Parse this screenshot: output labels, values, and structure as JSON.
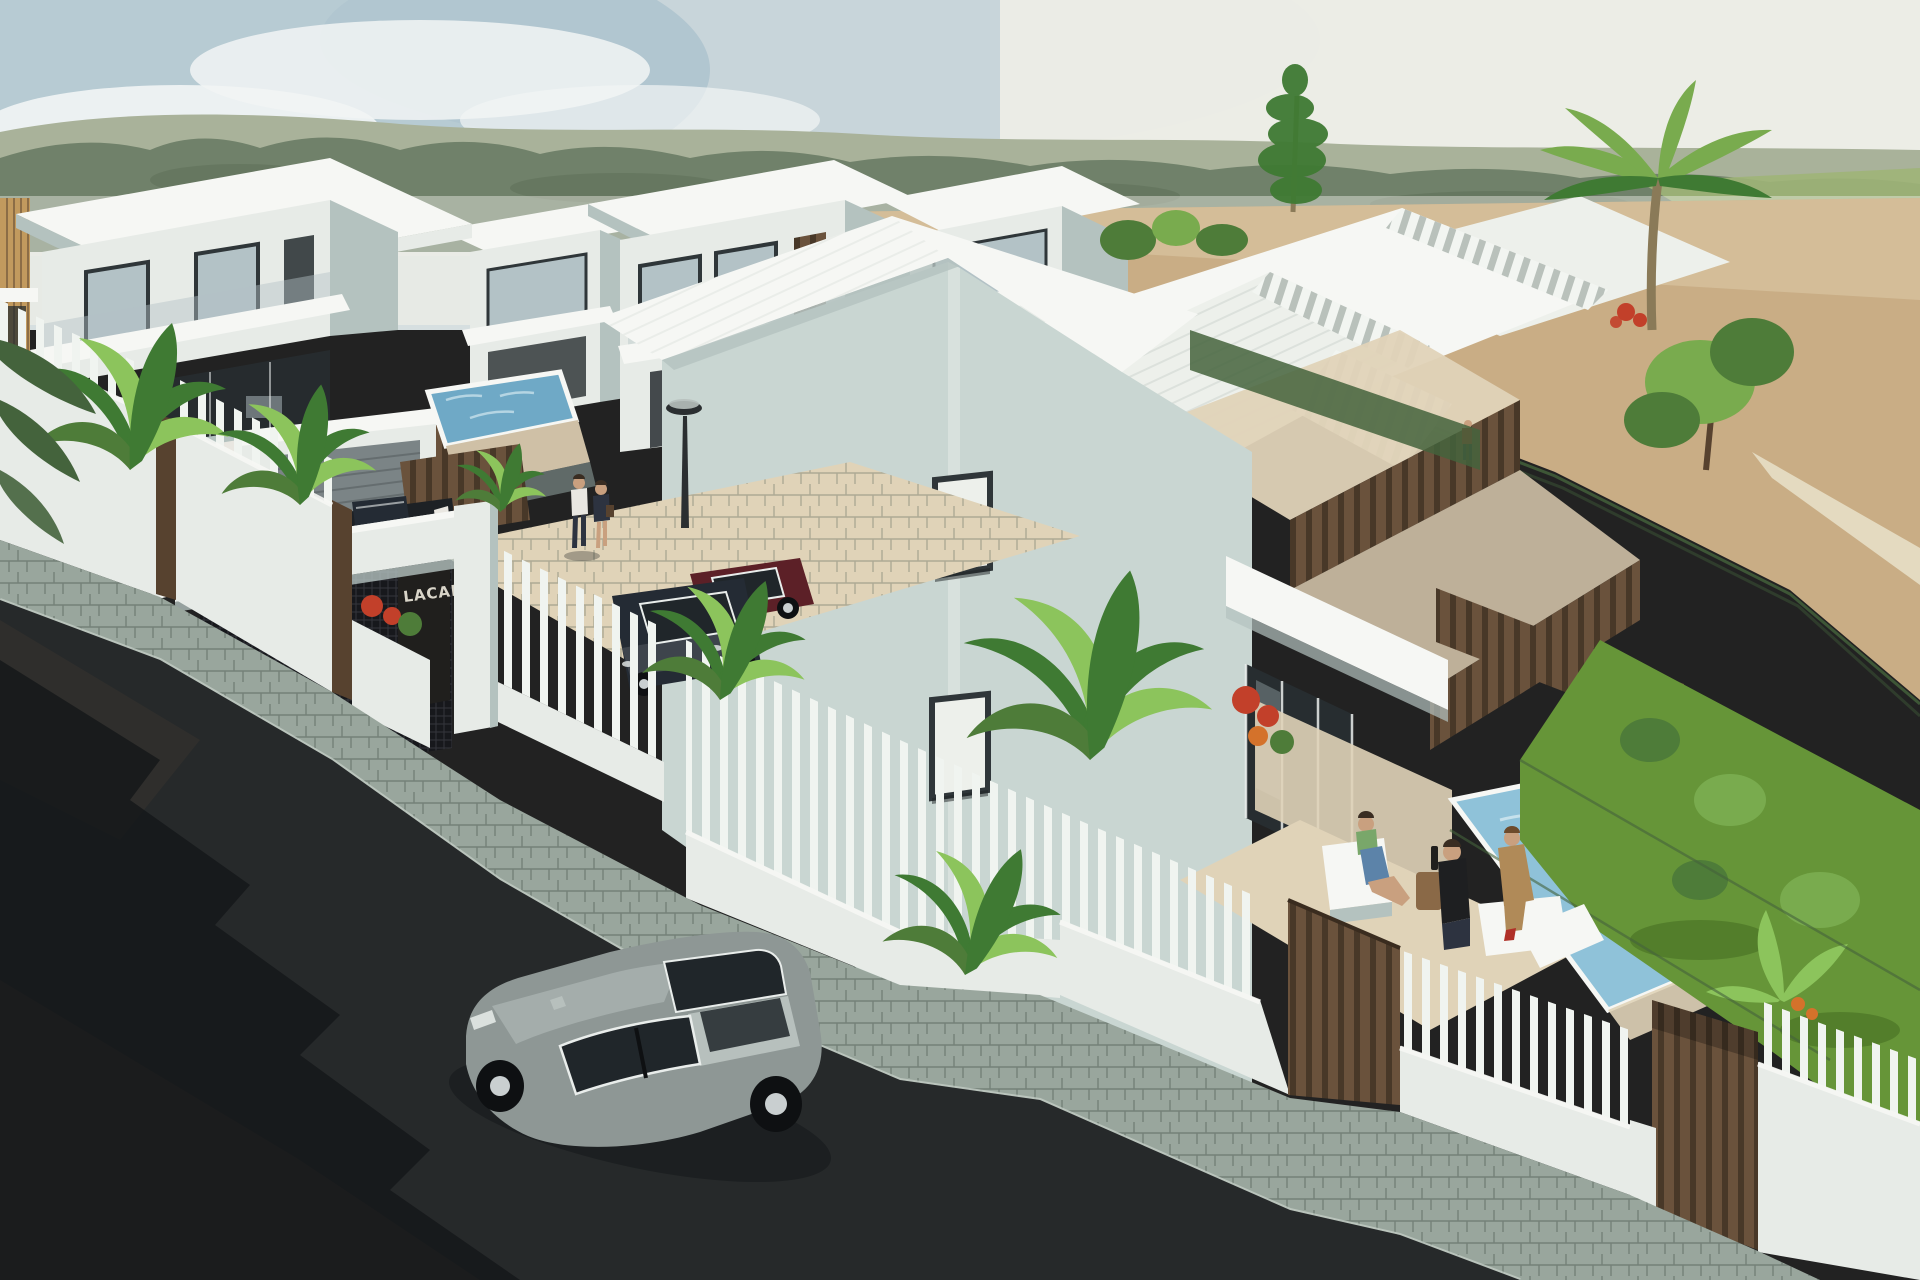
{
  "scene": {
    "title": "Aerial 3D render of a new-build development of modern white villas with pools, gardens, perimeter fence and street",
    "sign": {
      "text": "LACAL"
    }
  },
  "palette": {
    "sky_mid": "#d6dfe0",
    "sky_low": "#eeeee7",
    "sky_blue": "#9fb9c8",
    "cloud": "#f2f5f5",
    "hill_far": "#a9b29a",
    "hill_near": "#70816a",
    "hill_dark": "#5c6e55",
    "meadow": "#9fb478",
    "sand": "#c9ad85",
    "sand_light": "#ddcaa8",
    "path_light": "#e6dcc3",
    "roof_sun": "#f6f7f4",
    "roof_lit": "#edf0eb",
    "wall_white": "#e7ebe7",
    "wall_sage": "#c9d6d2",
    "wall_shade": "#b4c2bf",
    "wall_dark": "#93a5a2",
    "glass_frame": "#2f3639",
    "glass_pane": "#b3c2c6",
    "glass_dark": "#272d30",
    "wood": "#8a6947",
    "wood_dark": "#57422f",
    "slat": "#6a523c",
    "slat_dark": "#483828",
    "ochre": "#c29a5e",
    "tile": "#cfc0a6",
    "tile_light": "#e0d3b8",
    "pool": "#8fc2d9",
    "pool_deep": "#6fa9c6",
    "sparkle": "#d3e8f0",
    "grass": "#669538",
    "grass_dark": "#4b7527",
    "bush": "#4e7c39",
    "bush_light": "#79ab4e",
    "foliage": "#3f7a33",
    "leaf_light": "#8cc45c",
    "hedge": "#44633c",
    "flower_red": "#c2402a",
    "flower_orange": "#d4722b",
    "trunk": "#8a7a58",
    "road": "#26292a",
    "road_brown": "#4a3e33",
    "shadow": "#141719",
    "sidewalk": "#99a69d",
    "curb": "#c2ccc4",
    "mesh": "#17181c",
    "shutter": "#7b8486",
    "sign_bg": "#201f1d",
    "sign_text": "#d9d5c9",
    "picket": "#f0f4f0",
    "car_body": "#8e9795",
    "car_roof": "#b7c0bd",
    "car_window": "#20262a",
    "car_trim": "#e9edeb",
    "tire": "#0e1012",
    "rim": "#c9cfd0",
    "car_maroon": "#5c2027",
    "car_dark": "#242b34",
    "pickup": "#1d2125",
    "lamp": "#2b2f31",
    "skin": "#c9a07f",
    "hair_dark": "#3a2d22",
    "shirt_white": "#e9e7e1",
    "pants_dark": "#2d3340",
    "top_blue": "#5c83a9",
    "top_green": "#79a76a",
    "top_black": "#1e1f21",
    "outfit_tan": "#b08a58",
    "shoe_red": "#b03028"
  }
}
